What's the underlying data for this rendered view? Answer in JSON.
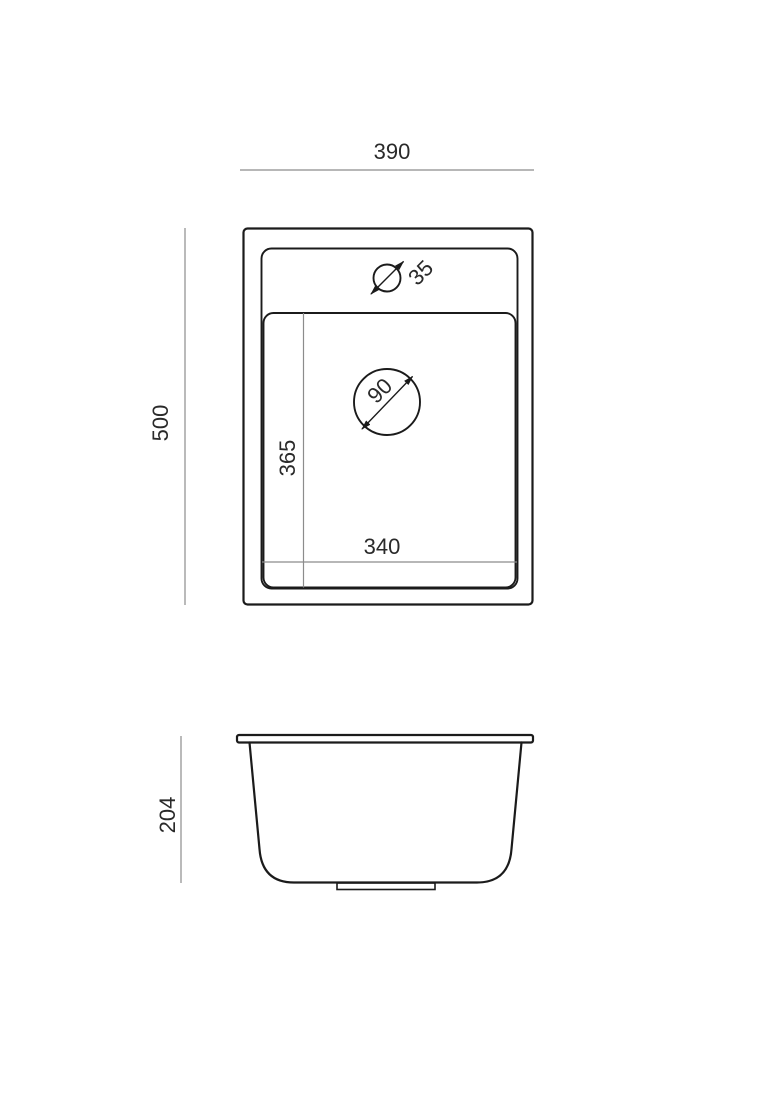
{
  "drawing": {
    "labels": {
      "width_390": "390",
      "depth_500": "500",
      "faucet_dia_35": "35",
      "drain_dia_90": "90",
      "bowl_len_365": "365",
      "bowl_wid_340": "340",
      "height_204": "204"
    },
    "colors": {
      "line": "#1b1b1b",
      "dimension_line": "#8c8c8c",
      "text": "#2a2a2a",
      "background": "#ffffff"
    }
  }
}
